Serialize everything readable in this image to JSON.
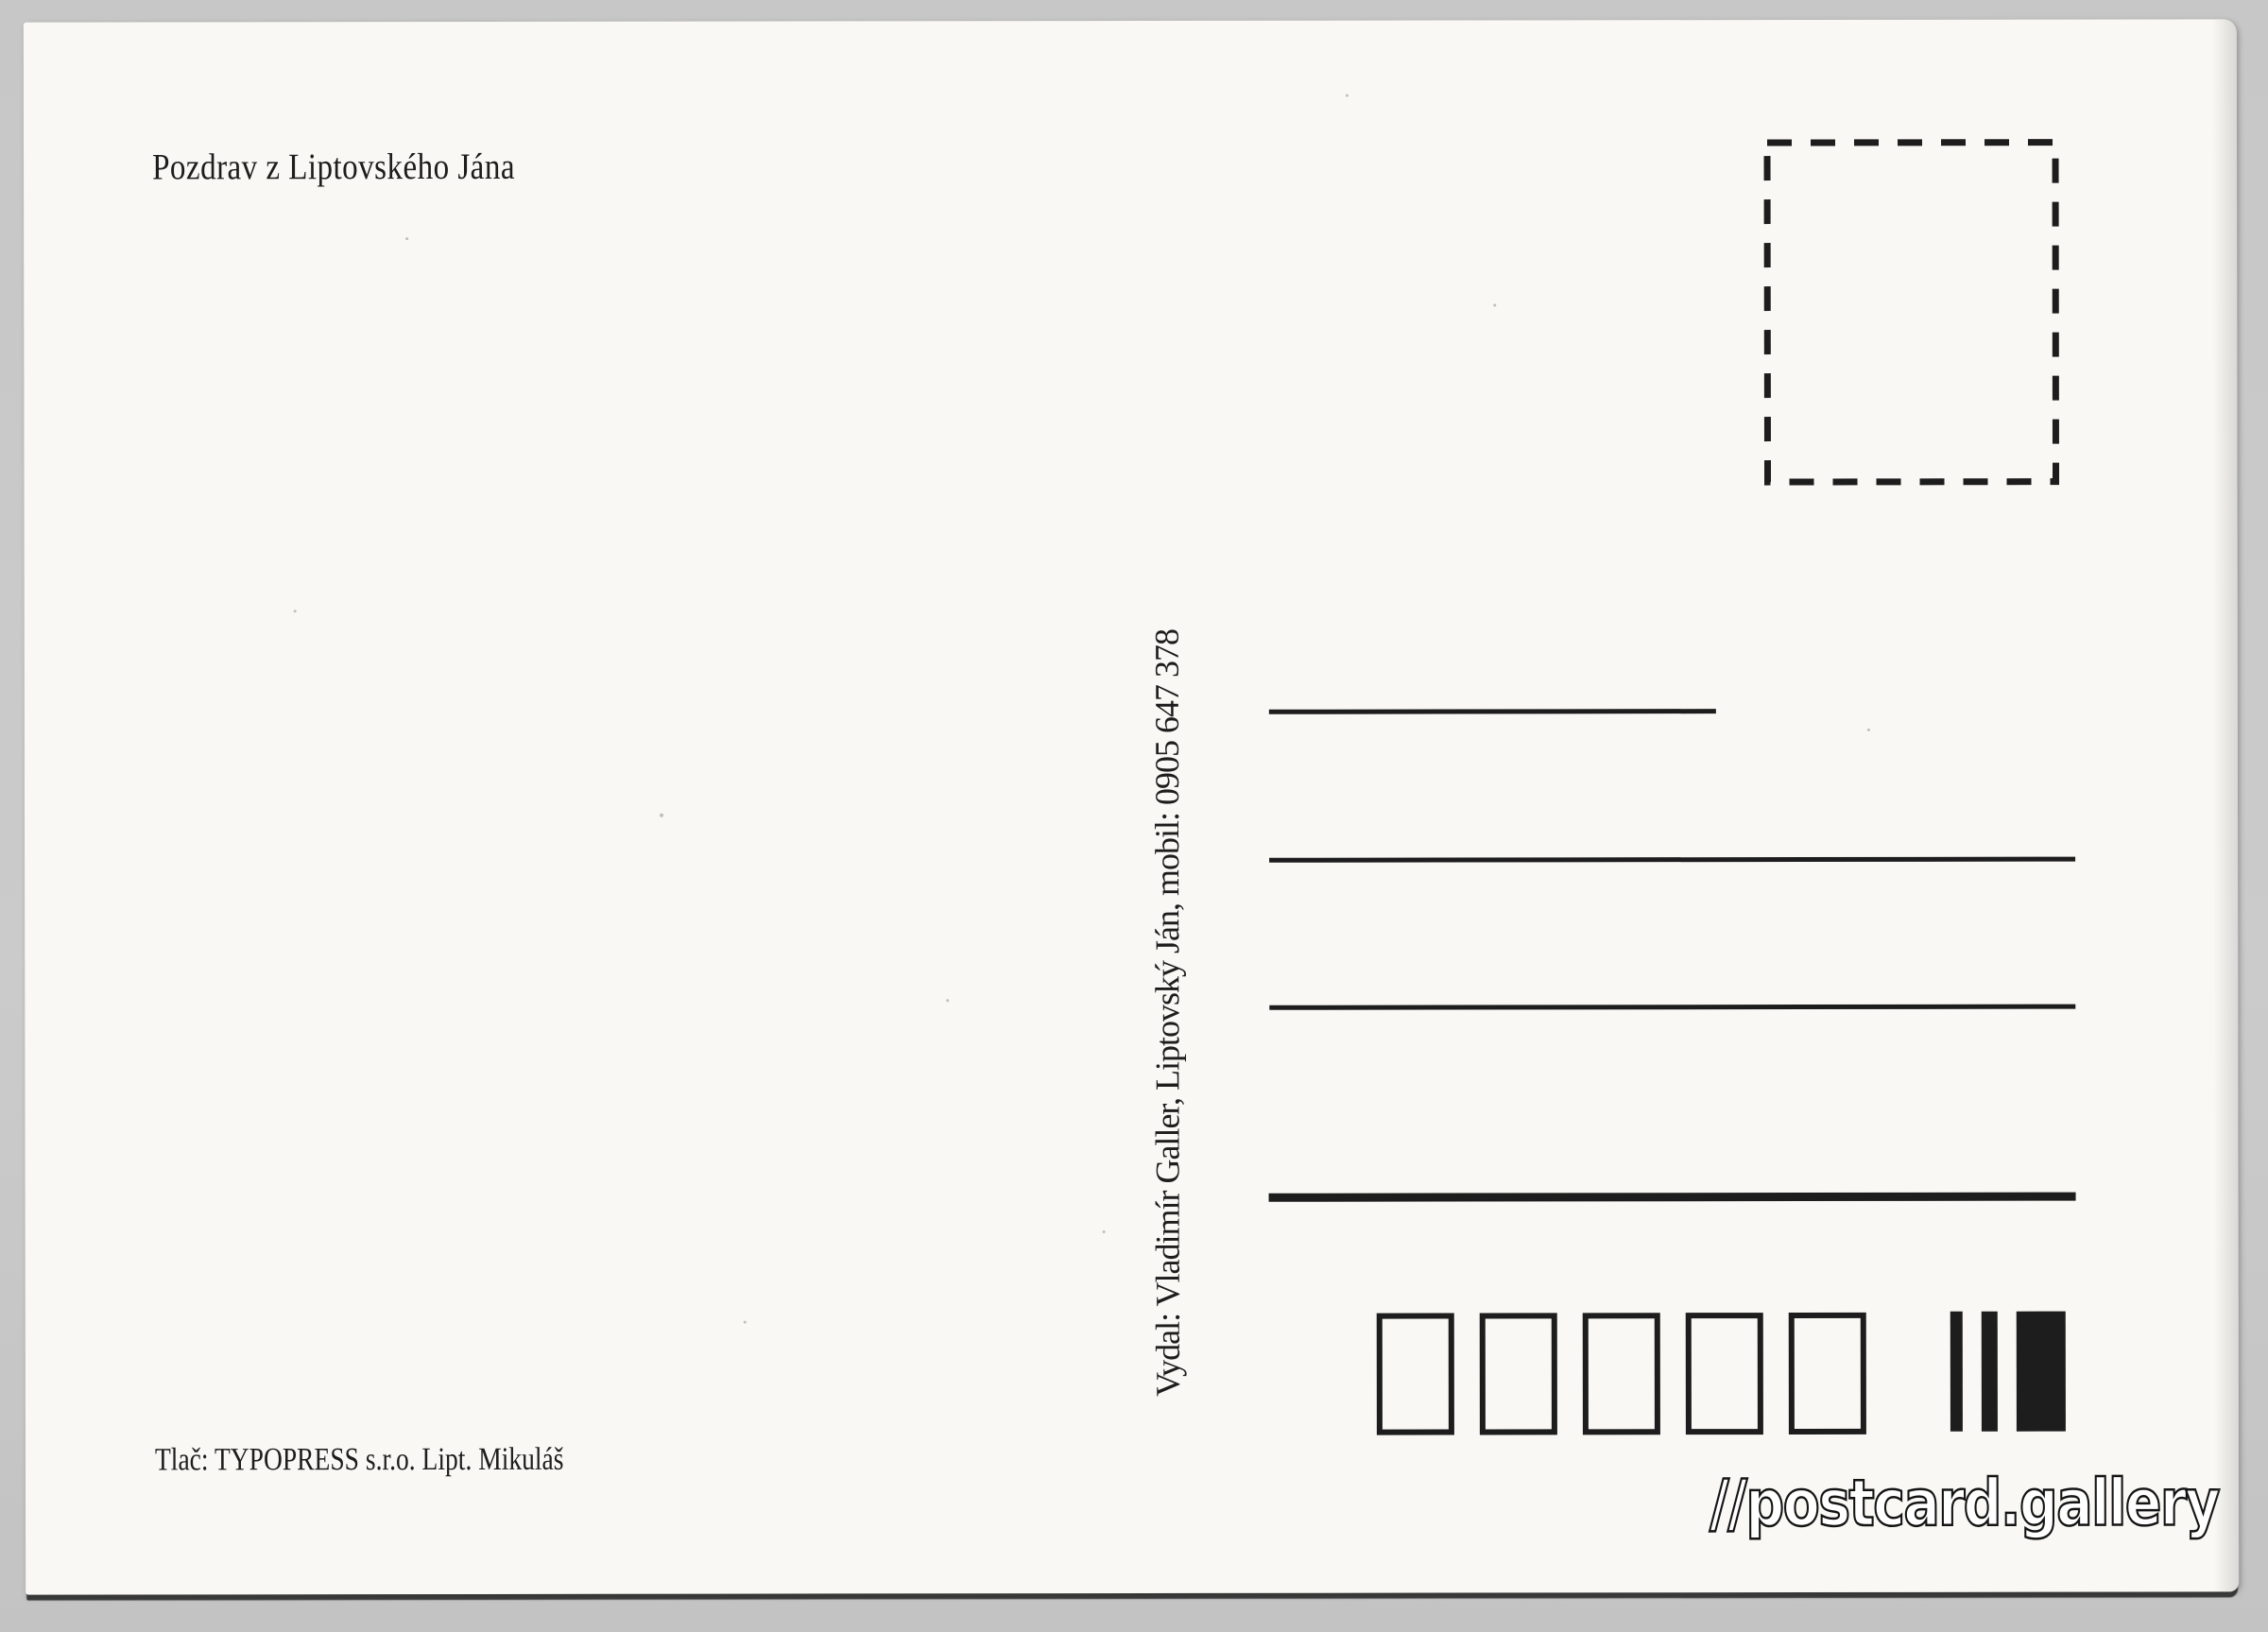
{
  "postcard": {
    "greeting": "Pozdrav z Liptovského Jána",
    "publisher_line": "Vydal: Vladimír Galler, Liptovský Ján, mobil: 0905 647 378",
    "printer_line": "Tlač: TYPOPRESS s.r.o. Lipt. Mikuláš",
    "watermark": "//postcard.gallery",
    "address_lines": {
      "count": 4
    },
    "postal_code_boxes": {
      "count": 5
    },
    "sorting_bars": {
      "count": 3
    },
    "colors": {
      "ink": "#1d1d1d",
      "paper": "#f9f8f4",
      "scan_background": "#c7c7c7",
      "watermark_fill": "#ffffff",
      "watermark_outline": "#141414"
    }
  }
}
